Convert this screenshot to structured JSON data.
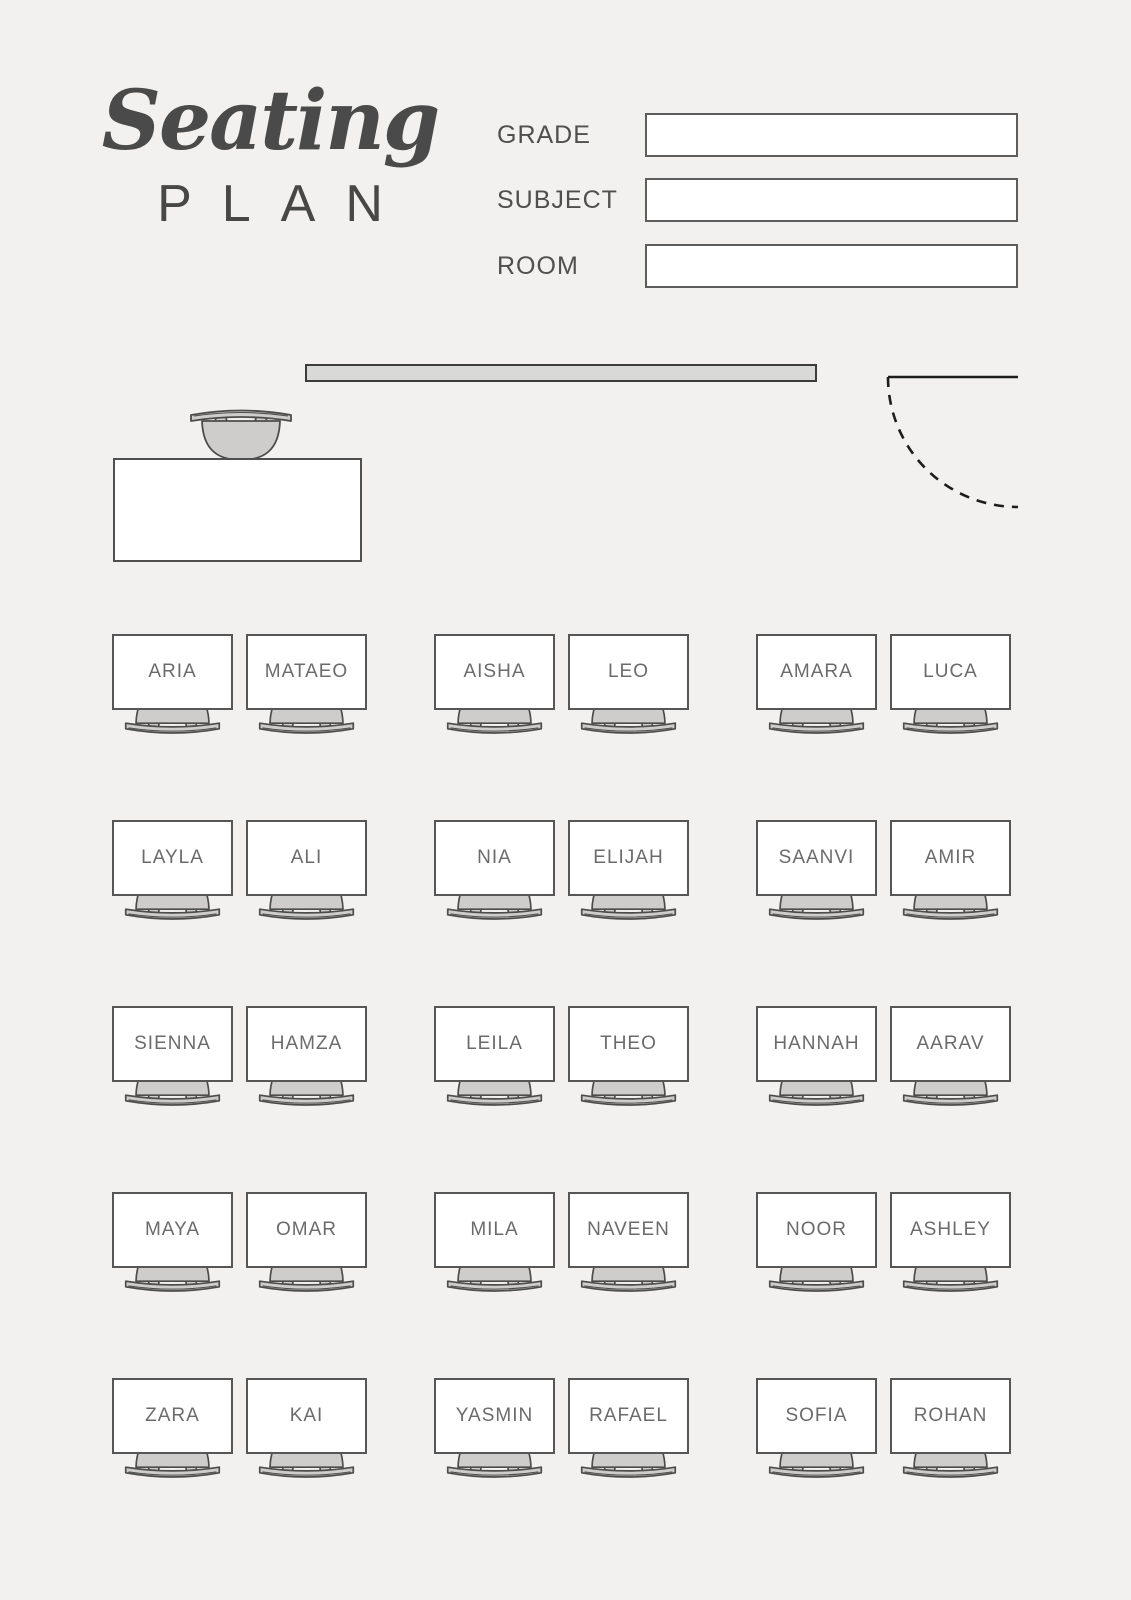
{
  "header": {
    "title_script": "Seating",
    "title_plan": "PLAN",
    "fields": [
      {
        "label": "GRADE",
        "value": "",
        "placeholder": ""
      },
      {
        "label": "SUBJECT",
        "value": "",
        "placeholder": ""
      },
      {
        "label": "ROOM",
        "value": "",
        "placeholder": ""
      }
    ]
  },
  "room": {
    "front_board_icon": "whiteboard-bar",
    "door_icon": "door-swing-arc",
    "teacher_desk_icon": "teacher-desk",
    "teacher_chair_icon": "chair-top-view-icon"
  },
  "seating": {
    "rows": [
      {
        "seats": [
          "ARIA",
          "MATAEO",
          "AISHA",
          "LEO",
          "AMARA",
          "LUCA"
        ]
      },
      {
        "seats": [
          "LAYLA",
          "ALI",
          "NIA",
          "ELIJAH",
          "SAANVI",
          "AMIR"
        ]
      },
      {
        "seats": [
          "SIENNA",
          "HAMZA",
          "LEILA",
          "THEO",
          "HANNAH",
          "AARAV"
        ]
      },
      {
        "seats": [
          "MAYA",
          "OMAR",
          "MILA",
          "NAVEEN",
          "NOOR",
          "ASHLEY"
        ]
      },
      {
        "seats": [
          "ZARA",
          "KAI",
          "YASMIN",
          "RAFAEL",
          "SOFIA",
          "ROHAN"
        ]
      }
    ]
  },
  "colors": {
    "page_background": "#f2f1ef",
    "ink": "#4a4a4a",
    "desk_border": "#565656",
    "desk_fill": "#ffffff",
    "chair_fill": "#cecdcb",
    "chair_outline": "#4c4c4c",
    "whiteboard_fill": "#d9d9d8",
    "name_text": "#6b6b6b"
  }
}
